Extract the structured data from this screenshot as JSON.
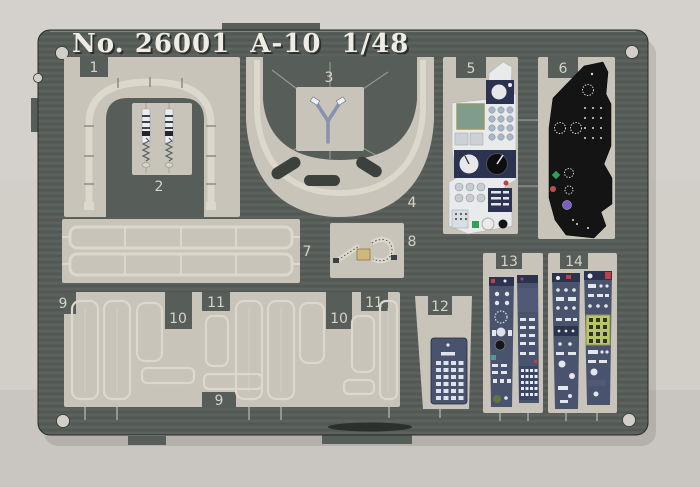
{
  "fret": {
    "title": "No. 26001  A-10  1/48",
    "part_labels": {
      "p1": "1",
      "p2": "2",
      "p3": "3",
      "p4": "4",
      "p5": "5",
      "p6": "6",
      "p7": "7",
      "p8": "8",
      "p9a": "9",
      "p9b": "9",
      "p10a": "10",
      "p10b": "10",
      "p11a": "11",
      "p11b": "11",
      "p12": "12",
      "p13": "13",
      "p14": "14"
    }
  },
  "colors": {
    "bg": "#d2cfc9",
    "fret": "#575d58",
    "fret-dark": "#3c413d",
    "etch": "#c8c4b9",
    "metal": "#dcd8cc",
    "metal-hi": "#eeece4",
    "label": "#d6d3c9",
    "panel-navy": "#49536e",
    "panel-navy-dark": "#2b3350",
    "panel-black": "#141414",
    "panel-white": "#e9eaeb",
    "screen-green": "#7e9d8c",
    "accent-red": "#c24040",
    "accent-green": "#2fa05a",
    "accent-purple": "#7a5fc0",
    "accent-yellowgreen": "#b9c46b",
    "accent-teal": "#4d9a9a"
  }
}
